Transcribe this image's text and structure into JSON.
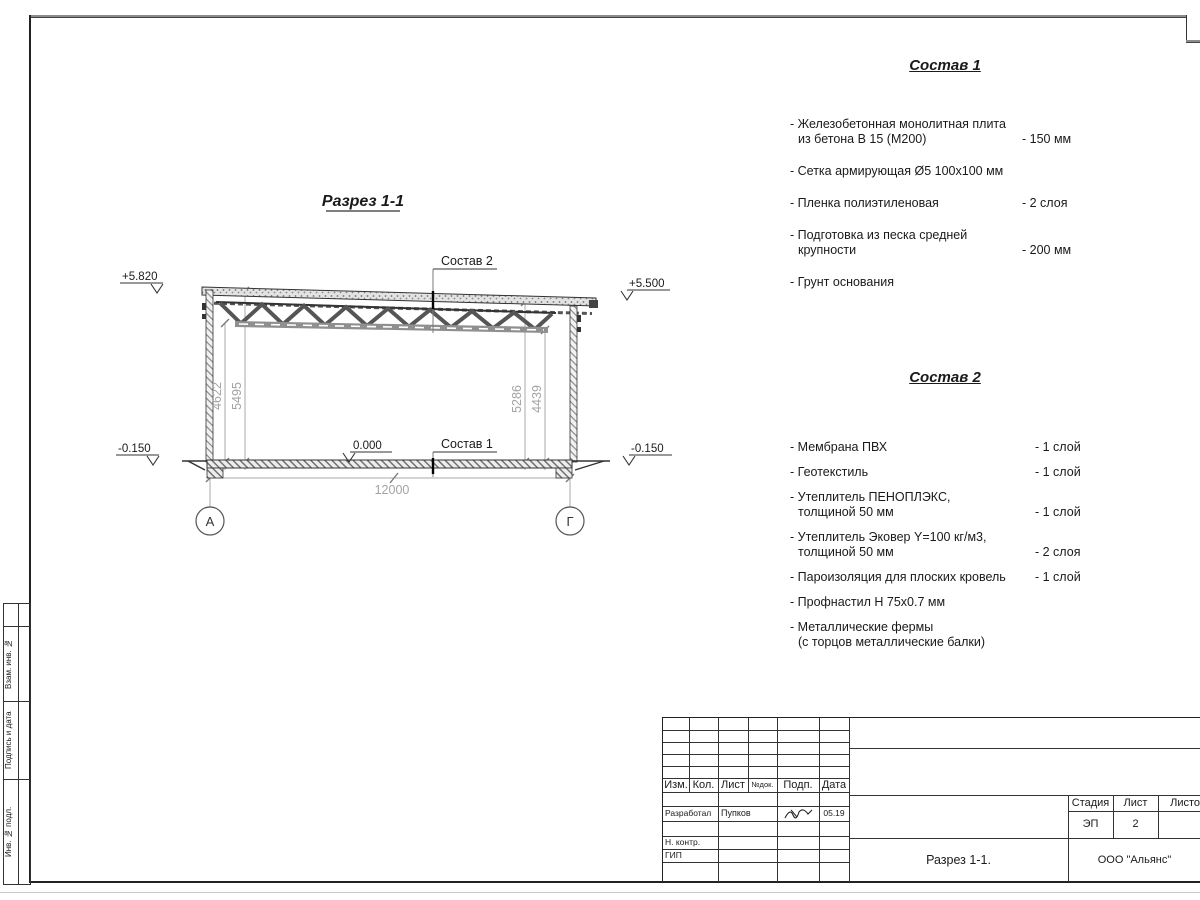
{
  "drawing": {
    "title": "Разрез 1-1",
    "elev_roof_left": "+5.820",
    "elev_roof_right": "+5.500",
    "elev_zero": "0.000",
    "elev_ground_left": "-0.150",
    "elev_ground_right": "-0.150",
    "dim_span": "12000",
    "dim_left_inner": "4622",
    "dim_left_outer": "5495",
    "dim_right_inner": "5286",
    "dim_right_outer": "4439",
    "axis_left": "А",
    "axis_right": "Г",
    "callout_roof": "Состав 2",
    "callout_floor": "Состав 1"
  },
  "composition1": {
    "title": "Состав 1",
    "items": [
      {
        "line1": "- Железобетонная  монолитная плита",
        "line2": "из бетона В 15 (М200)",
        "value": "- 150 мм"
      },
      {
        "line1": "- Сетка армирующая Ø5 100х100 мм",
        "line2": "",
        "value": ""
      },
      {
        "line1": "- Пленка полиэтиленовая",
        "line2": "",
        "value": "-  2 слоя"
      },
      {
        "line1": "- Подготовка из песка средней",
        "line2": "крупности",
        "value": "- 200 мм"
      },
      {
        "line1": "- Грунт основания",
        "line2": "",
        "value": ""
      }
    ]
  },
  "composition2": {
    "title": "Состав 2",
    "items": [
      {
        "line1": "- Мембрана ПВХ",
        "line2": "",
        "value": "- 1 слой"
      },
      {
        "line1": "- Геотекстиль",
        "line2": "",
        "value": "- 1 слой"
      },
      {
        "line1": "- Утеплитель ПЕНОПЛЭКС,",
        "line2": "толщиной 50 мм",
        "value": "- 1 слой"
      },
      {
        "line1": "- Утеплитель Эковер Y=100 кг/м3,",
        "line2": "толщиной 50 мм",
        "value": "- 2 слоя"
      },
      {
        "line1": "- Пароизоляция для плоских кровель",
        "line2": "",
        "value": "- 1 слой"
      },
      {
        "line1": "- Профнастил Н 75х0.7 мм",
        "line2": "",
        "value": ""
      },
      {
        "line1": "- Металлические фермы",
        "line2": "(с торцов металлические балки)",
        "value": ""
      }
    ]
  },
  "titleblock": {
    "col_izm": "Изм.",
    "col_kol": "Кол.",
    "col_list": "Лист",
    "col_ndok": "№док.",
    "col_podp": "Подп.",
    "col_data": "Дата",
    "developer_role": "Разработал",
    "developer_name": "Пупков",
    "developer_date": "05.19",
    "ncontr_role": "Н. контр.",
    "gip_role": "ГИП",
    "stage_label": "Стадия",
    "sheet_label": "Лист",
    "sheets_label": "Листов",
    "stage_value": "ЭП",
    "sheet_value": "2",
    "doc_name": "Разрез 1-1.",
    "company": "ООО \"Альянс\""
  },
  "frame": {
    "label_vzam": "Взам. инв. №",
    "label_podp": "Подпись и дата",
    "label_inv": "Инв. № подл."
  }
}
